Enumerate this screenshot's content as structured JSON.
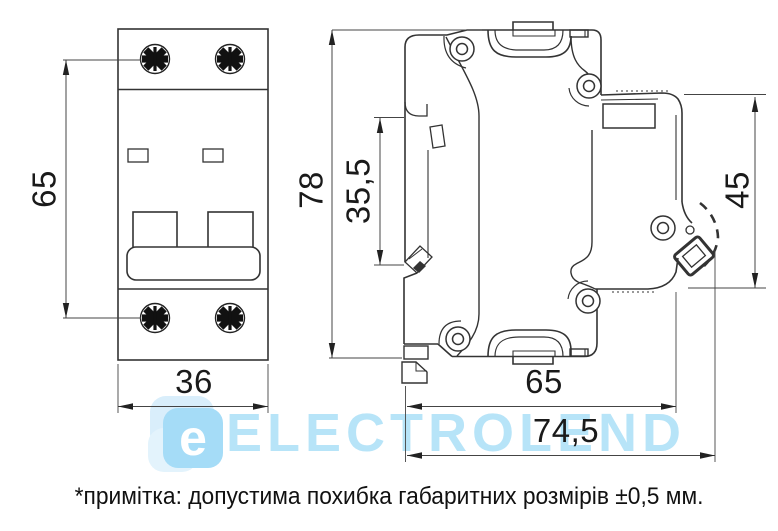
{
  "document_type": "dimensional drawing of a 2-pole modular circuit breaker",
  "dims": {
    "front_height": "65",
    "front_width": "36",
    "side_height": "78",
    "rail_offset": "35,5",
    "clip_zone": "45",
    "depth_body": "65",
    "depth_total": "74,5"
  },
  "note": {
    "text": "*примітка: допустима похибка габаритних розмірів ±0,5 мм."
  },
  "watermark": {
    "logo_letter": "e",
    "brand": "ELECTROLEND",
    "blue": "#a5dcf7",
    "light_blue": "#d9eefb"
  },
  "colors": {
    "line": "#333333",
    "dim_line": "#444444",
    "dim_text": "#1a1a1a"
  }
}
